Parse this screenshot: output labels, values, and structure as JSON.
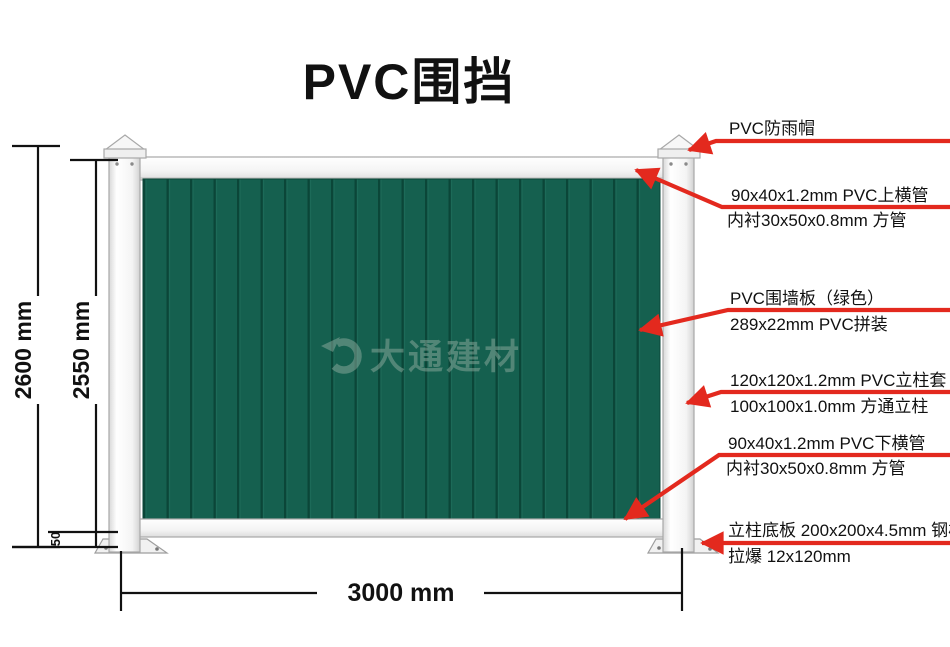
{
  "title": "PVC围挡",
  "watermark": {
    "brand": "大通建材",
    "logo": "swoosh-logo"
  },
  "dimensions": {
    "total_height": "2600 mm",
    "panel_height": "2550 mm",
    "ground_clearance": "50",
    "width": "3000 mm"
  },
  "callouts": [
    {
      "line1": "PVC防雨帽",
      "line2": ""
    },
    {
      "line1": "90x40x1.2mm PVC上横管",
      "line2": "内衬30x50x0.8mm 方管"
    },
    {
      "line1": "PVC围墙板（绿色）",
      "line2": "289x22mm PVC拼装"
    },
    {
      "line1": "120x120x1.2mm PVC立柱套",
      "line2": "100x100x1.0mm 方通立柱"
    },
    {
      "line1": "90x40x1.2mm PVC下横管",
      "line2": "内衬30x50x0.8mm 方管"
    },
    {
      "line1": "立柱底板 200x200x4.5mm 钢板",
      "line2": "拉爆 12x120mm"
    }
  ],
  "colors": {
    "panel_green": "#15604F",
    "rib_dark": "#0B4638",
    "rib_light": "#1C6A58",
    "callout_red": "#E3291E",
    "post_white": "#F6F6F6",
    "post_edge": "#A8A8A8",
    "text_black": "#111111",
    "watermark_green": "#8FAC9F"
  }
}
